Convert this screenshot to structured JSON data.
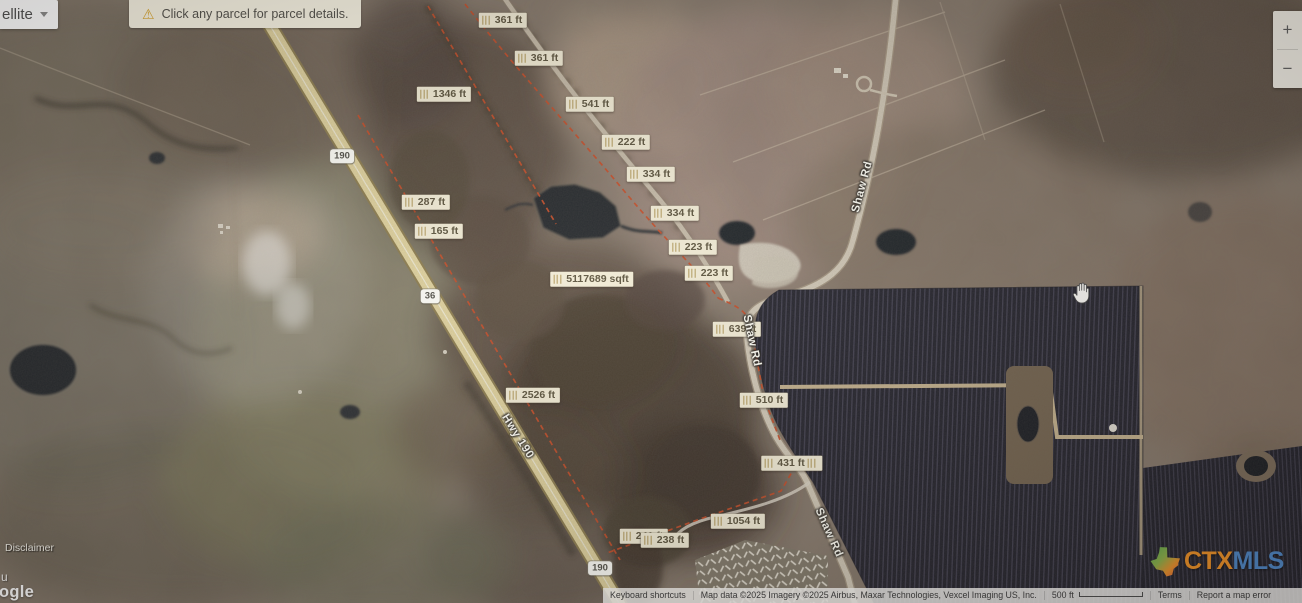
{
  "map_type_button": {
    "label_partial": "ellite"
  },
  "notification_bar": {
    "text": "Click any parcel for parcel details.",
    "icon": "warning-triangle"
  },
  "zoom_control": {
    "zoom_in": "+",
    "zoom_out": "−"
  },
  "measurement_labels": [
    {
      "text": "361 ft"
    },
    {
      "text": "361 ft"
    },
    {
      "text": "1346 ft"
    },
    {
      "text": "541 ft"
    },
    {
      "text": "222 ft"
    },
    {
      "text": "334 ft"
    },
    {
      "text": "334 ft"
    },
    {
      "text": "287 ft"
    },
    {
      "text": "165 ft"
    },
    {
      "text": "223 ft"
    },
    {
      "text": "223 ft"
    },
    {
      "text": "5117689 sqft"
    },
    {
      "text": "639 ft"
    },
    {
      "text": "2526 ft"
    },
    {
      "text": "510 ft"
    },
    {
      "text": "431 ft"
    },
    {
      "text": "1054 ft"
    },
    {
      "text": "241 ft"
    },
    {
      "text": "238 ft"
    }
  ],
  "road_shields": [
    {
      "text": "190"
    },
    {
      "text": "36"
    },
    {
      "text": "190"
    }
  ],
  "road_names": [
    {
      "text": "Shaw Rd"
    },
    {
      "text": "Shaw Rd"
    },
    {
      "text": "Shaw Rd"
    },
    {
      "text": "Hwy 190"
    }
  ],
  "overlays": {
    "disclaimer": "Disclaimer",
    "google_watermark_partial": "ogle",
    "stray_glyph": "u"
  },
  "attribution_bar": {
    "keyboard_shortcuts": "Keyboard shortcuts",
    "map_data": "Map data ©2025 Imagery ©2025 Airbus, Maxar Technologies, Vexcel Imaging US, Inc.",
    "scale_label": "500 ft",
    "terms": "Terms",
    "report_error": "Report a map error"
  },
  "brand_logo": {
    "ctx": "CTX",
    "mls": "MLS",
    "icon": "texas-state-icon"
  },
  "colors": {
    "highway": "#e7d9a2",
    "parcel_line": "#c94c26",
    "label_bg": "#f1ebd5",
    "label_text": "#5f5741",
    "ctx_orange": "#ee9227",
    "mls_blue": "#4f88c7",
    "solar_dark": "#21212b"
  }
}
